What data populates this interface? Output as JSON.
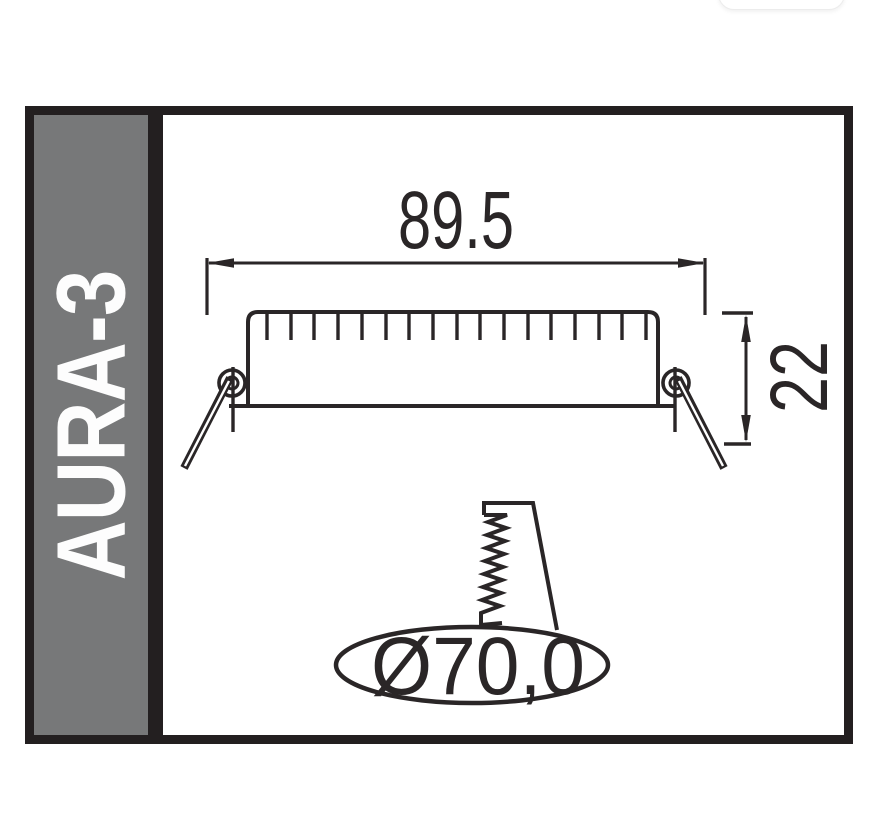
{
  "product": {
    "name": "AURA-3"
  },
  "dimensions": {
    "width": "89.5",
    "height": "22",
    "cutout": "Ø70,0"
  },
  "colors": {
    "sidebar_background": "#777879",
    "frame_black": "#231f20",
    "drawing_line": "#2a2627",
    "sidebar_text": "#fdfdfd",
    "pill_border": "#ececec"
  }
}
